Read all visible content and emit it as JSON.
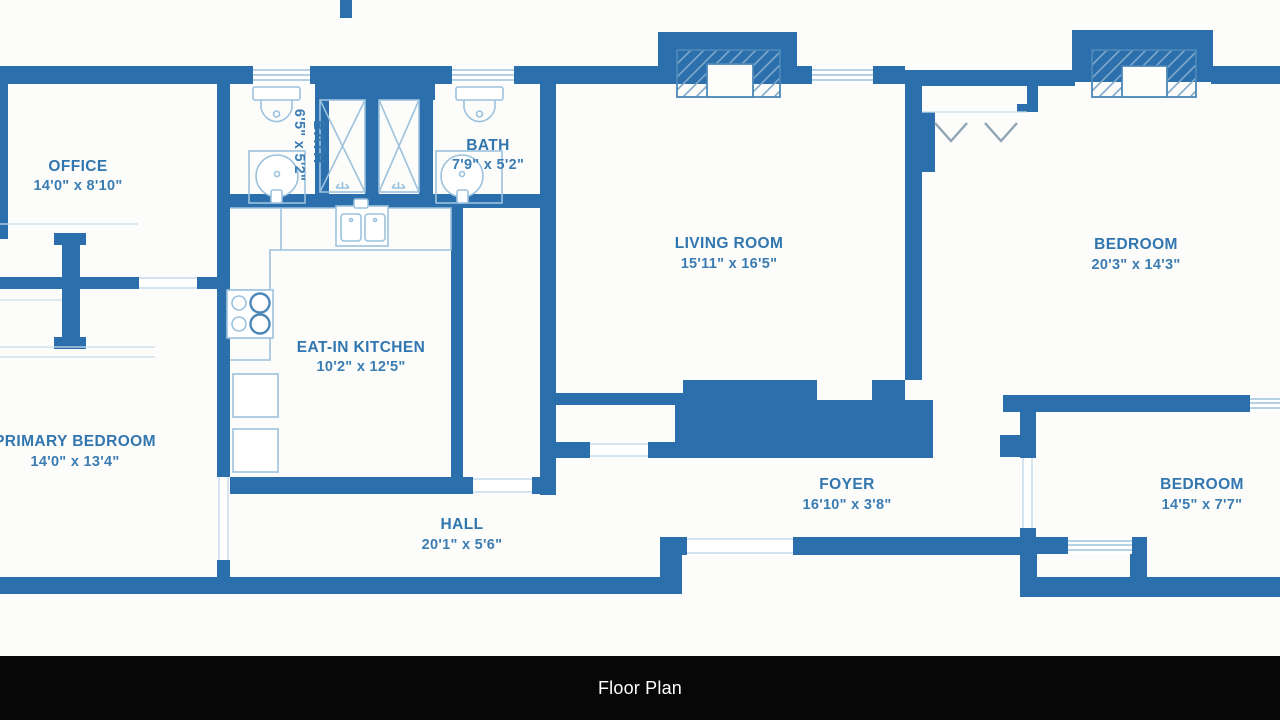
{
  "caption": {
    "label": "Floor Plan"
  },
  "palette": {
    "wall_blue": "#2b6fad",
    "fixture_blue": "#9cc2de",
    "label_blue": "#3176af",
    "background": "#fcfcfa",
    "caption_bg": "#070707",
    "caption_text": "#ffffff"
  },
  "rooms": {
    "office": {
      "name": "OFFICE",
      "dims": "14'0\" x 8'10\""
    },
    "bath_left": {
      "name": "BATH",
      "dims": "6'5\" x 5'2\""
    },
    "bath_right": {
      "name": "BATH",
      "dims": "7'9\" x 5'2\""
    },
    "living_room": {
      "name": "LIVING ROOM",
      "dims": "15'11\" x 16'5\""
    },
    "bedroom_right": {
      "name": "BEDROOM",
      "dims": "20'3\" x 14'3\""
    },
    "kitchen": {
      "name": "EAT-IN KITCHEN",
      "dims": "10'2\" x 12'5\""
    },
    "primary_bedroom": {
      "name": "PRIMARY BEDROOM",
      "dims": "14'0\" x 13'4\""
    },
    "foyer": {
      "name": "FOYER",
      "dims": "16'10\" x 3'8\""
    },
    "hall": {
      "name": "HALL",
      "dims": "20'1\" x 5'6\""
    },
    "bedroom_bottom": {
      "name": "BEDROOM",
      "dims": "14'5\" x 7'7\""
    }
  }
}
